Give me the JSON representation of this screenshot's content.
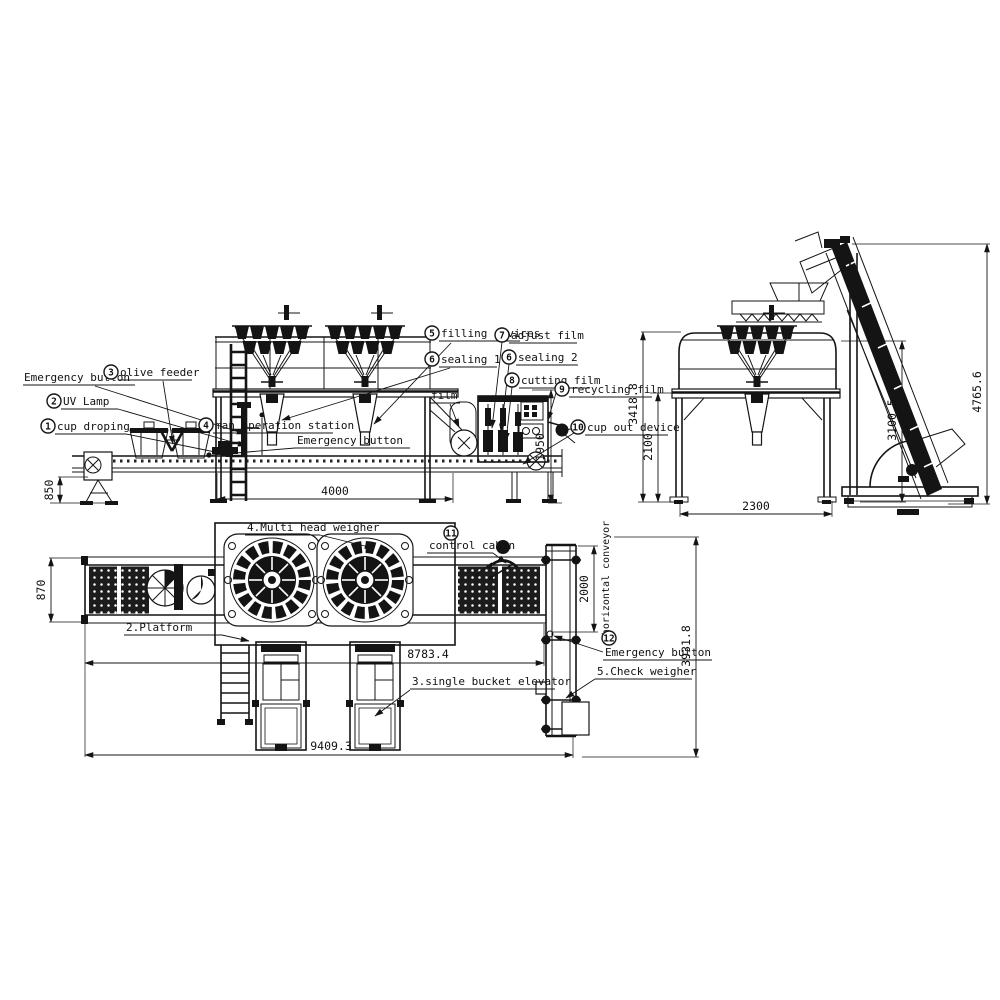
{
  "drawing_type": "packaging line general arrangement",
  "callouts": {
    "cup_droping": {
      "num": "1",
      "label": "cup droping"
    },
    "uv_lamp": {
      "num": "2",
      "label": "UV Lamp"
    },
    "olive_feeder": {
      "num": "3",
      "label": "olive feeder"
    },
    "man_operation_station": {
      "num": "4",
      "label": "man operation station"
    },
    "filling_devices": {
      "num": "5",
      "label": "filling devices"
    },
    "sealing_1": {
      "num": "6",
      "label": "sealing 1"
    },
    "sealing_2": {
      "num": "6",
      "label": "sealing 2"
    },
    "adjust_film": {
      "num": "7",
      "label": "adjust film"
    },
    "cutting_film": {
      "num": "8",
      "label": "cutting film"
    },
    "recycling_film": {
      "num": "9",
      "label": "recycling film"
    },
    "cup_out_device": {
      "num": "10",
      "label": "cup out device"
    },
    "control_cabin": {
      "num": "11",
      "label": "control cabin"
    },
    "horizontal_conveyor": {
      "num": "12",
      "label": "horizontal conveyor"
    }
  },
  "labels": {
    "emergency_button_1": "Emergency button",
    "emergency_button_2": "Emergency button",
    "emergency_button_3": "Emergency button",
    "film": "film",
    "multi_head_weigher": "4.Multi head weigher",
    "platform": "2.Platform",
    "single_bucket_elevator": "3.single bucket elevator",
    "check_weigher": "5.Check weigher",
    "side_note": "n"
  },
  "dimensions": {
    "front": {
      "conveyor_height": "850",
      "platform_span": "4000",
      "machine_height": "1950"
    },
    "side": {
      "platform_height": "2100",
      "guard_height": "3418.8",
      "weigher_height": "3100.5",
      "elevator_height": "4765.6",
      "base_depth": "2300"
    },
    "plan": {
      "conveyor_width": "870",
      "checkweigher_length": "2000",
      "line_length": "8783.4",
      "overall_length": "9409.3",
      "cross_line_length": "3931.8"
    }
  }
}
